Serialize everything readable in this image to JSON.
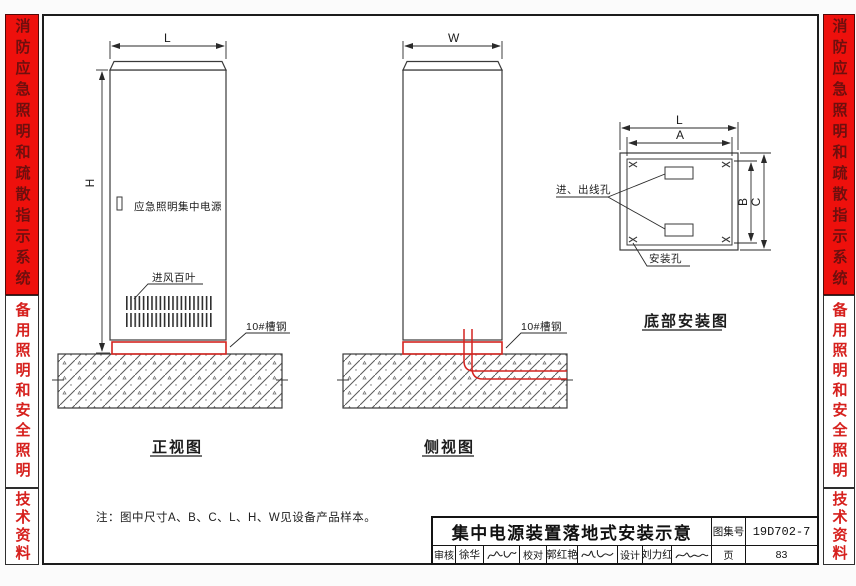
{
  "sidebar": {
    "top_tab": "消防应急照明和疏散指示系统",
    "middle_tab": "备用照明和安全照明",
    "bottom_tab": "技术资料"
  },
  "front_view": {
    "title": "正视图",
    "dim_width": "L",
    "dim_height": "H",
    "device_label": "应急照明集中电源",
    "louver_label": "进风百叶",
    "channel_label": "10#槽钢"
  },
  "side_view": {
    "title": "侧视图",
    "dim_width": "W",
    "channel_label": "10#槽钢"
  },
  "bottom_view": {
    "title": "底部安装图",
    "dim_l": "L",
    "dim_a": "A",
    "dim_b": "B",
    "dim_c": "C",
    "wire_hole_label": "进、出线孔",
    "mount_hole_label": "安装孔"
  },
  "note": "注：图中尺寸A、B、C、L、H、W见设备产品样本。",
  "title_block": {
    "title": "集中电源装置落地式安装示意",
    "atlas_no_label": "图集号",
    "atlas_no": "19D702-7",
    "page_label": "页",
    "page": "83",
    "review_label": "审核",
    "reviewer": "徐华",
    "check_label": "校对",
    "checker": "郭红艳",
    "design_label": "设计",
    "designer": "刘力红"
  },
  "colors": {
    "accent_red": "#ee100c",
    "line_red": "#d42420"
  }
}
